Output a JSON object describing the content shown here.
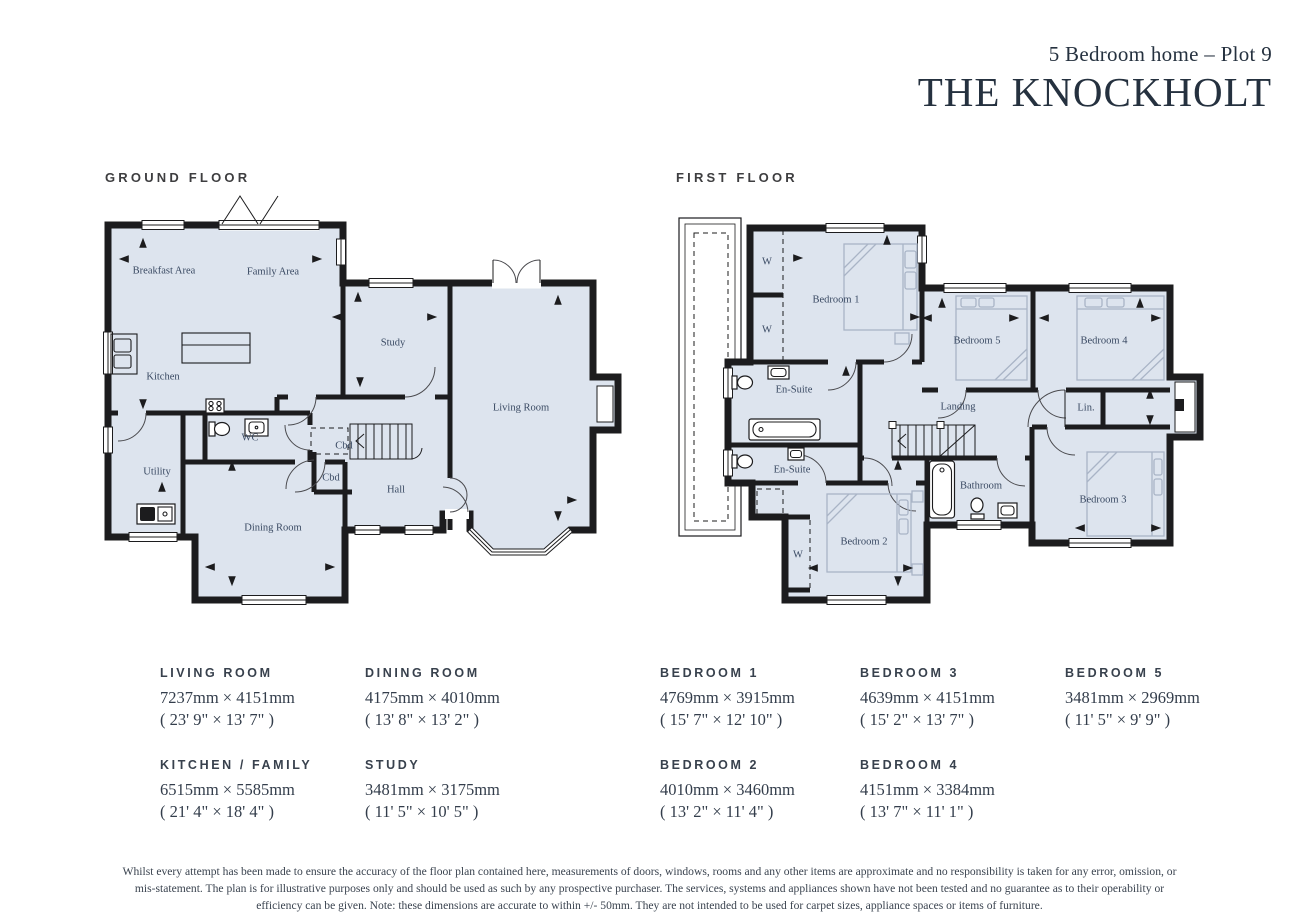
{
  "header": {
    "subtitle": "5 Bedroom home – Plot 9",
    "title": "THE KNOCKHOLT"
  },
  "ground_floor": {
    "heading": "GROUND FLOOR",
    "labels": [
      "Breakfast Area",
      "Family Area",
      "Kitchen",
      "Study",
      "Living Room",
      "WC",
      "Utility",
      "Cbd",
      "Cbd",
      "Hall",
      "Dining Room"
    ]
  },
  "first_floor": {
    "heading": "FIRST FLOOR",
    "labels": [
      "Bedroom 1",
      "W",
      "W",
      "En-Suite",
      "Bedroom 5",
      "Bedroom 4",
      "Landing",
      "Lin.",
      "Bathroom",
      "Bedroom 3",
      "En-Suite",
      "W",
      "Bedroom 2"
    ]
  },
  "dimensions": {
    "columns": [
      {
        "items": [
          {
            "name": "LIVING ROOM",
            "mm": "7237mm × 4151mm",
            "ft": "( 23' 9\" × 13' 7\" )"
          },
          {
            "name": "KITCHEN / FAMILY",
            "mm": "6515mm × 5585mm",
            "ft": "( 21' 4\" × 18' 4\" )"
          }
        ]
      },
      {
        "items": [
          {
            "name": "DINING ROOM",
            "mm": "4175mm × 4010mm",
            "ft": "( 13' 8\" × 13' 2\" )"
          },
          {
            "name": "STUDY",
            "mm": "3481mm × 3175mm",
            "ft": "( 11' 5\" × 10' 5\" )"
          }
        ]
      },
      {
        "items": [
          {
            "name": "BEDROOM 1",
            "mm": "4769mm × 3915mm",
            "ft": "( 15' 7\" × 12' 10\" )"
          },
          {
            "name": "BEDROOM 2",
            "mm": "4010mm × 3460mm",
            "ft": "( 13' 2\" × 11' 4\" )"
          }
        ]
      },
      {
        "items": [
          {
            "name": "BEDROOM 3",
            "mm": "4639mm × 4151mm",
            "ft": "( 15' 2\" × 13' 7\" )"
          },
          {
            "name": "BEDROOM 4",
            "mm": "4151mm × 3384mm",
            "ft": "( 13' 7\" × 11' 1\" )"
          }
        ]
      },
      {
        "items": [
          {
            "name": "BEDROOM 5",
            "mm": "3481mm × 2969mm",
            "ft": "( 11' 5\" × 9' 9\" )"
          }
        ]
      }
    ]
  },
  "disclaimer": "Whilst every attempt has been made to ensure the accuracy of the floor plan contained here, measurements of doors, windows, rooms and any other items are approximate and no responsibility is taken for any error, omission, or mis-statement. The plan is for illustrative purposes only and should be used as such by any prospective purchaser. The services, systems and appliances shown have not been tested and no guarantee as to their operability or efficiency can be given. Note: these dimensions are accurate to within +/- 50mm. They are not intended to be used for carpet sizes, appliance spaces or items of furniture.",
  "colors": {
    "wall": "#1c1c1e",
    "room_fill": "#dde4ee",
    "label_text": "#3a4a63",
    "accent_text": "#25313f",
    "furniture": "#a9b4c6"
  }
}
